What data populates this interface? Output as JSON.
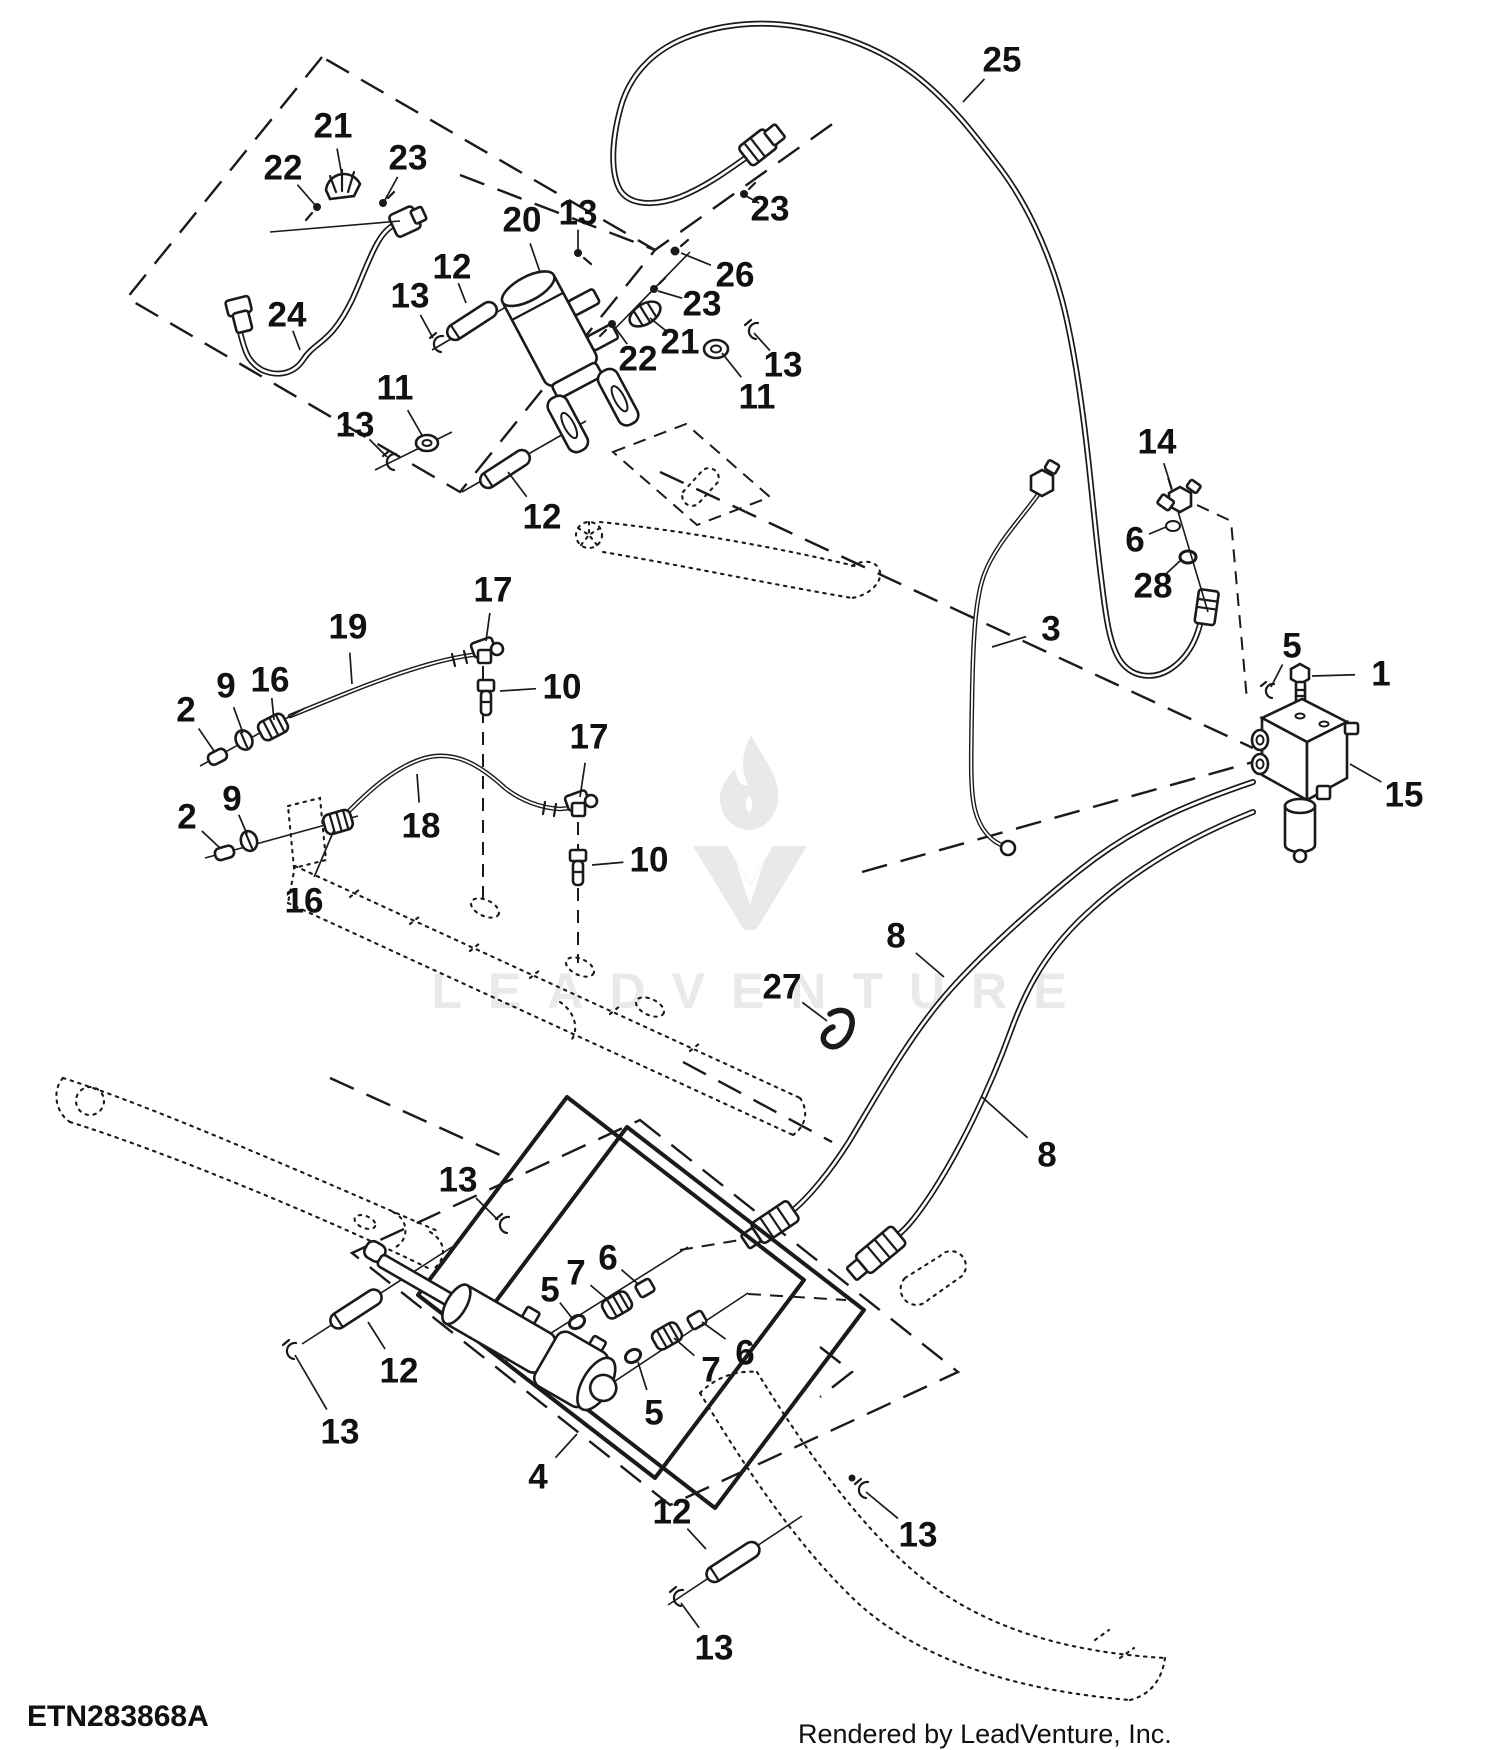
{
  "canvas": {
    "width": 1500,
    "height": 1750,
    "background": "#ffffff",
    "line_color": "#1a1a1a"
  },
  "watermark": {
    "text": "LEADVENTURE",
    "color": "#e9e9e9"
  },
  "footer": {
    "part_code": "ETN283868A",
    "rendered_by": "Rendered by LeadVenture, Inc."
  },
  "callouts": [
    {
      "n": "25",
      "x": 1002,
      "y": 60,
      "tx": 963,
      "ty": 102
    },
    {
      "n": "21",
      "x": 333,
      "y": 126,
      "tx": 342,
      "ty": 176
    },
    {
      "n": "22",
      "x": 283,
      "y": 168,
      "tx": 315,
      "ty": 205
    },
    {
      "n": "23",
      "x": 408,
      "y": 158,
      "tx": 385,
      "ty": 200
    },
    {
      "n": "20",
      "x": 522,
      "y": 220,
      "tx": 540,
      "ty": 272
    },
    {
      "n": "13",
      "x": 578,
      "y": 213,
      "tx": 578,
      "ty": 250
    },
    {
      "n": "23",
      "x": 770,
      "y": 209,
      "tx": 746,
      "ty": 196
    },
    {
      "n": "12",
      "x": 452,
      "y": 267,
      "tx": 466,
      "ty": 303
    },
    {
      "n": "26",
      "x": 735,
      "y": 275,
      "tx": 681,
      "ty": 253
    },
    {
      "n": "13",
      "x": 410,
      "y": 296,
      "tx": 433,
      "ty": 338
    },
    {
      "n": "23",
      "x": 702,
      "y": 304,
      "tx": 658,
      "ty": 291
    },
    {
      "n": "24",
      "x": 287,
      "y": 315,
      "tx": 300,
      "ty": 350
    },
    {
      "n": "21",
      "x": 680,
      "y": 342,
      "tx": 650,
      "ty": 318
    },
    {
      "n": "22",
      "x": 638,
      "y": 359,
      "tx": 614,
      "ty": 326
    },
    {
      "n": "13",
      "x": 783,
      "y": 365,
      "tx": 754,
      "ty": 333
    },
    {
      "n": "11",
      "x": 757,
      "y": 397,
      "tx": 722,
      "ty": 353
    },
    {
      "n": "11",
      "x": 395,
      "y": 388,
      "tx": 423,
      "ty": 437
    },
    {
      "n": "13",
      "x": 355,
      "y": 425,
      "tx": 387,
      "ty": 457
    },
    {
      "n": "12",
      "x": 542,
      "y": 517,
      "tx": 508,
      "ty": 472
    },
    {
      "n": "14",
      "x": 1157,
      "y": 442,
      "tx": 1172,
      "ty": 489
    },
    {
      "n": "6",
      "x": 1135,
      "y": 540,
      "tx": 1166,
      "ty": 527
    },
    {
      "n": "28",
      "x": 1153,
      "y": 586,
      "tx": 1181,
      "ty": 560
    },
    {
      "n": "3",
      "x": 1051,
      "y": 629,
      "tx": 992,
      "ty": 647
    },
    {
      "n": "5",
      "x": 1292,
      "y": 646,
      "tx": 1271,
      "ty": 687
    },
    {
      "n": "1",
      "x": 1381,
      "y": 674,
      "tx": 1312,
      "ty": 676
    },
    {
      "n": "15",
      "x": 1404,
      "y": 795,
      "tx": 1350,
      "ty": 764
    },
    {
      "n": "17",
      "x": 493,
      "y": 590,
      "tx": 486,
      "ty": 641
    },
    {
      "n": "19",
      "x": 348,
      "y": 627,
      "tx": 352,
      "ty": 684
    },
    {
      "n": "9",
      "x": 226,
      "y": 686,
      "tx": 243,
      "ty": 733
    },
    {
      "n": "16",
      "x": 270,
      "y": 680,
      "tx": 274,
      "ty": 720
    },
    {
      "n": "2",
      "x": 186,
      "y": 710,
      "tx": 214,
      "ty": 751
    },
    {
      "n": "10",
      "x": 562,
      "y": 687,
      "tx": 500,
      "ty": 691
    },
    {
      "n": "17",
      "x": 589,
      "y": 737,
      "tx": 580,
      "ty": 797
    },
    {
      "n": "9",
      "x": 232,
      "y": 799,
      "tx": 247,
      "ty": 834
    },
    {
      "n": "2",
      "x": 187,
      "y": 817,
      "tx": 220,
      "ty": 848
    },
    {
      "n": "18",
      "x": 421,
      "y": 826,
      "tx": 417,
      "ty": 774
    },
    {
      "n": "16",
      "x": 304,
      "y": 901,
      "tx": 334,
      "ty": 830
    },
    {
      "n": "10",
      "x": 649,
      "y": 860,
      "tx": 592,
      "ty": 865
    },
    {
      "n": "27",
      "x": 782,
      "y": 987,
      "tx": 827,
      "ty": 1021
    },
    {
      "n": "8",
      "x": 896,
      "y": 936,
      "tx": 944,
      "ty": 977
    },
    {
      "n": "8",
      "x": 1047,
      "y": 1155,
      "tx": 982,
      "ty": 1097
    },
    {
      "n": "13",
      "x": 458,
      "y": 1180,
      "tx": 498,
      "ty": 1220
    },
    {
      "n": "6",
      "x": 608,
      "y": 1258,
      "tx": 638,
      "ty": 1284
    },
    {
      "n": "7",
      "x": 576,
      "y": 1273,
      "tx": 608,
      "ty": 1300
    },
    {
      "n": "5",
      "x": 550,
      "y": 1290,
      "tx": 572,
      "ty": 1318
    },
    {
      "n": "12",
      "x": 399,
      "y": 1371,
      "tx": 368,
      "ty": 1322
    },
    {
      "n": "13",
      "x": 340,
      "y": 1432,
      "tx": 295,
      "ty": 1355
    },
    {
      "n": "6",
      "x": 745,
      "y": 1353,
      "tx": 702,
      "ty": 1322
    },
    {
      "n": "7",
      "x": 711,
      "y": 1370,
      "tx": 674,
      "ty": 1338
    },
    {
      "n": "5",
      "x": 654,
      "y": 1413,
      "tx": 638,
      "ty": 1362
    },
    {
      "n": "4",
      "x": 538,
      "y": 1477,
      "tx": 577,
      "ty": 1434
    },
    {
      "n": "12",
      "x": 672,
      "y": 1512,
      "tx": 706,
      "ty": 1549
    },
    {
      "n": "13",
      "x": 714,
      "y": 1648,
      "tx": 681,
      "ty": 1603
    },
    {
      "n": "13",
      "x": 918,
      "y": 1535,
      "tx": 866,
      "ty": 1492
    }
  ]
}
